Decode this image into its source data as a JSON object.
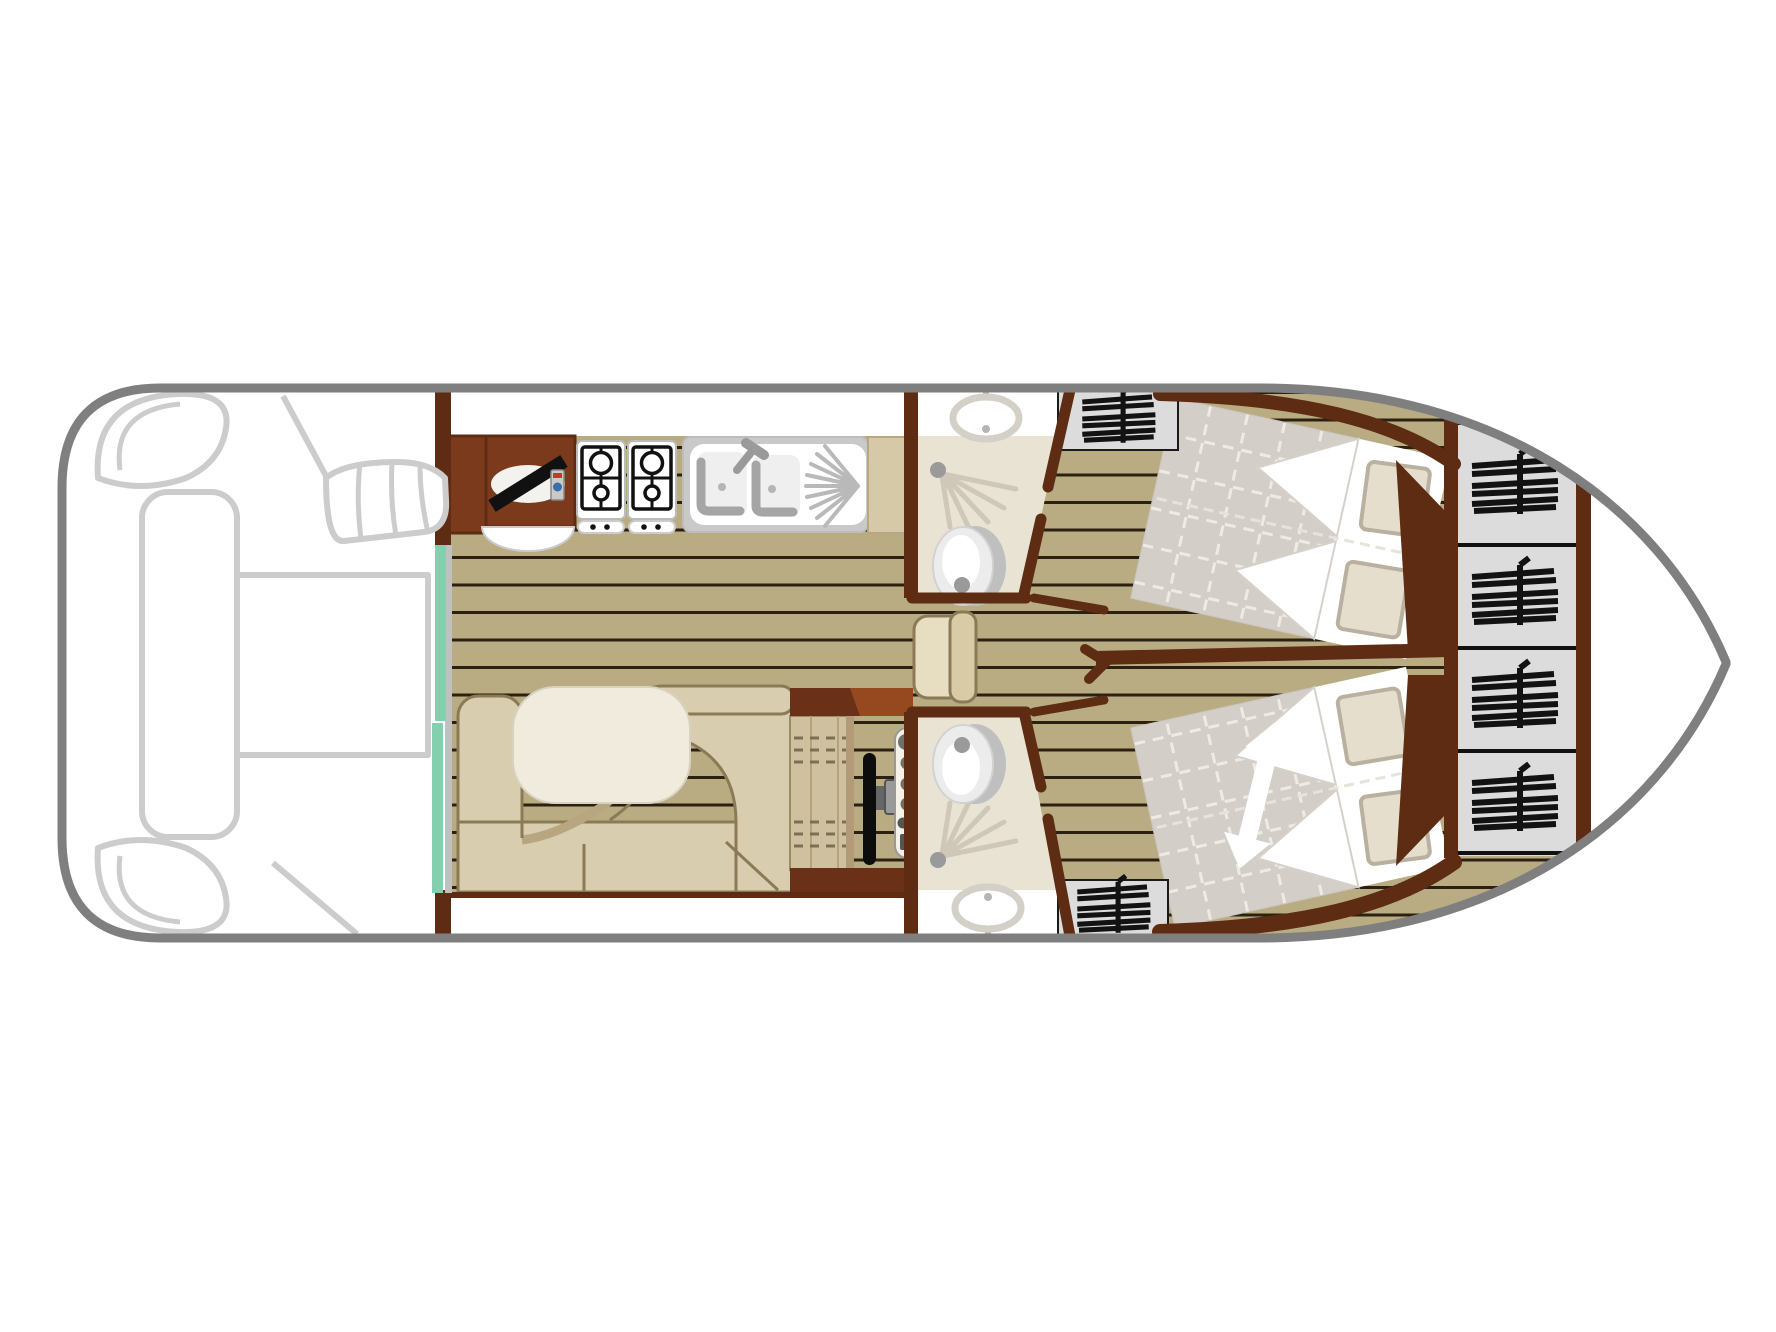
{
  "diagram": {
    "type": "boat-deck-plan",
    "kind": "top-view floor plan of a canal cruiser",
    "colors": {
      "hull_outline": "#7f7f7f",
      "deck_outline": "#cccccc",
      "wall": "#5d2c12",
      "cabinet": "#7c3a1d",
      "console_top": "#96491f",
      "floor": "#b9ac83",
      "floor_line": "#2b2113",
      "entry_door": "#84cfad",
      "door_track": "#c0c0c0",
      "bath_floor": "#e9e3d3",
      "wardrobe": "#dcdcdc",
      "hanger": "#121212",
      "duvet": "#d3cec7",
      "duvet_grid": "#eeebe5",
      "pillow": "#e5decd",
      "pillow_edge": "#b9b0a0",
      "sofa": "#d9cdb0",
      "sofa_line": "#8a7a55",
      "sofa_shade": "#b7a67f",
      "table": "#f0ebdc",
      "desk": "#cfc1a0",
      "counter_end": "#d6c9a8",
      "fixture": "#c9c9c9",
      "spray": "#cfc8b8",
      "steel": "#9a9a9a",
      "wheel": "#0d0d0d",
      "white": "#ffffff"
    },
    "areas": {
      "aft_deck": {
        "name": "aft deck",
        "features": [
          "corner-seat",
          "corner-seat",
          "side-bench",
          "deck-table",
          "steps"
        ]
      },
      "galley": {
        "name": "galley",
        "features": [
          "tv-icon",
          "gas-hob-icon",
          "gas-hob-icon",
          "double-sink-icon",
          "drainer-icon"
        ]
      },
      "saloon": {
        "name": "saloon",
        "features": [
          "u-sofa",
          "dinette-table",
          "sliding-entry-door"
        ]
      },
      "helm_station": {
        "name": "inner helm",
        "features": [
          "console",
          "chart-desk",
          "steering-wheel-icon",
          "instrument-panel",
          "helm-seat"
        ]
      },
      "bathroom_top": {
        "name": "shower room (starboard)",
        "features": [
          "washbasin-icon",
          "shower-icon",
          "toilet-icon"
        ]
      },
      "bathroom_bottom": {
        "name": "shower room (port)",
        "features": [
          "washbasin-icon",
          "shower-icon",
          "toilet-icon"
        ]
      },
      "cabin_top": {
        "name": "double cabin (starboard)",
        "features": [
          "double-bed",
          "pillow",
          "pillow",
          "wardrobe-hanger-icon"
        ]
      },
      "cabin_bottom": {
        "name": "double cabin (port)",
        "features": [
          "double-bed",
          "pillow",
          "pillow",
          "wardrobe-hanger-icon",
          "adjustable-bed-arrow-icon"
        ]
      },
      "bow": {
        "name": "bow lockers",
        "features": [
          "wardrobe-hanger-icon",
          "wardrobe-hanger-icon",
          "wardrobe-hanger-icon",
          "wardrobe-hanger-icon"
        ]
      }
    }
  }
}
